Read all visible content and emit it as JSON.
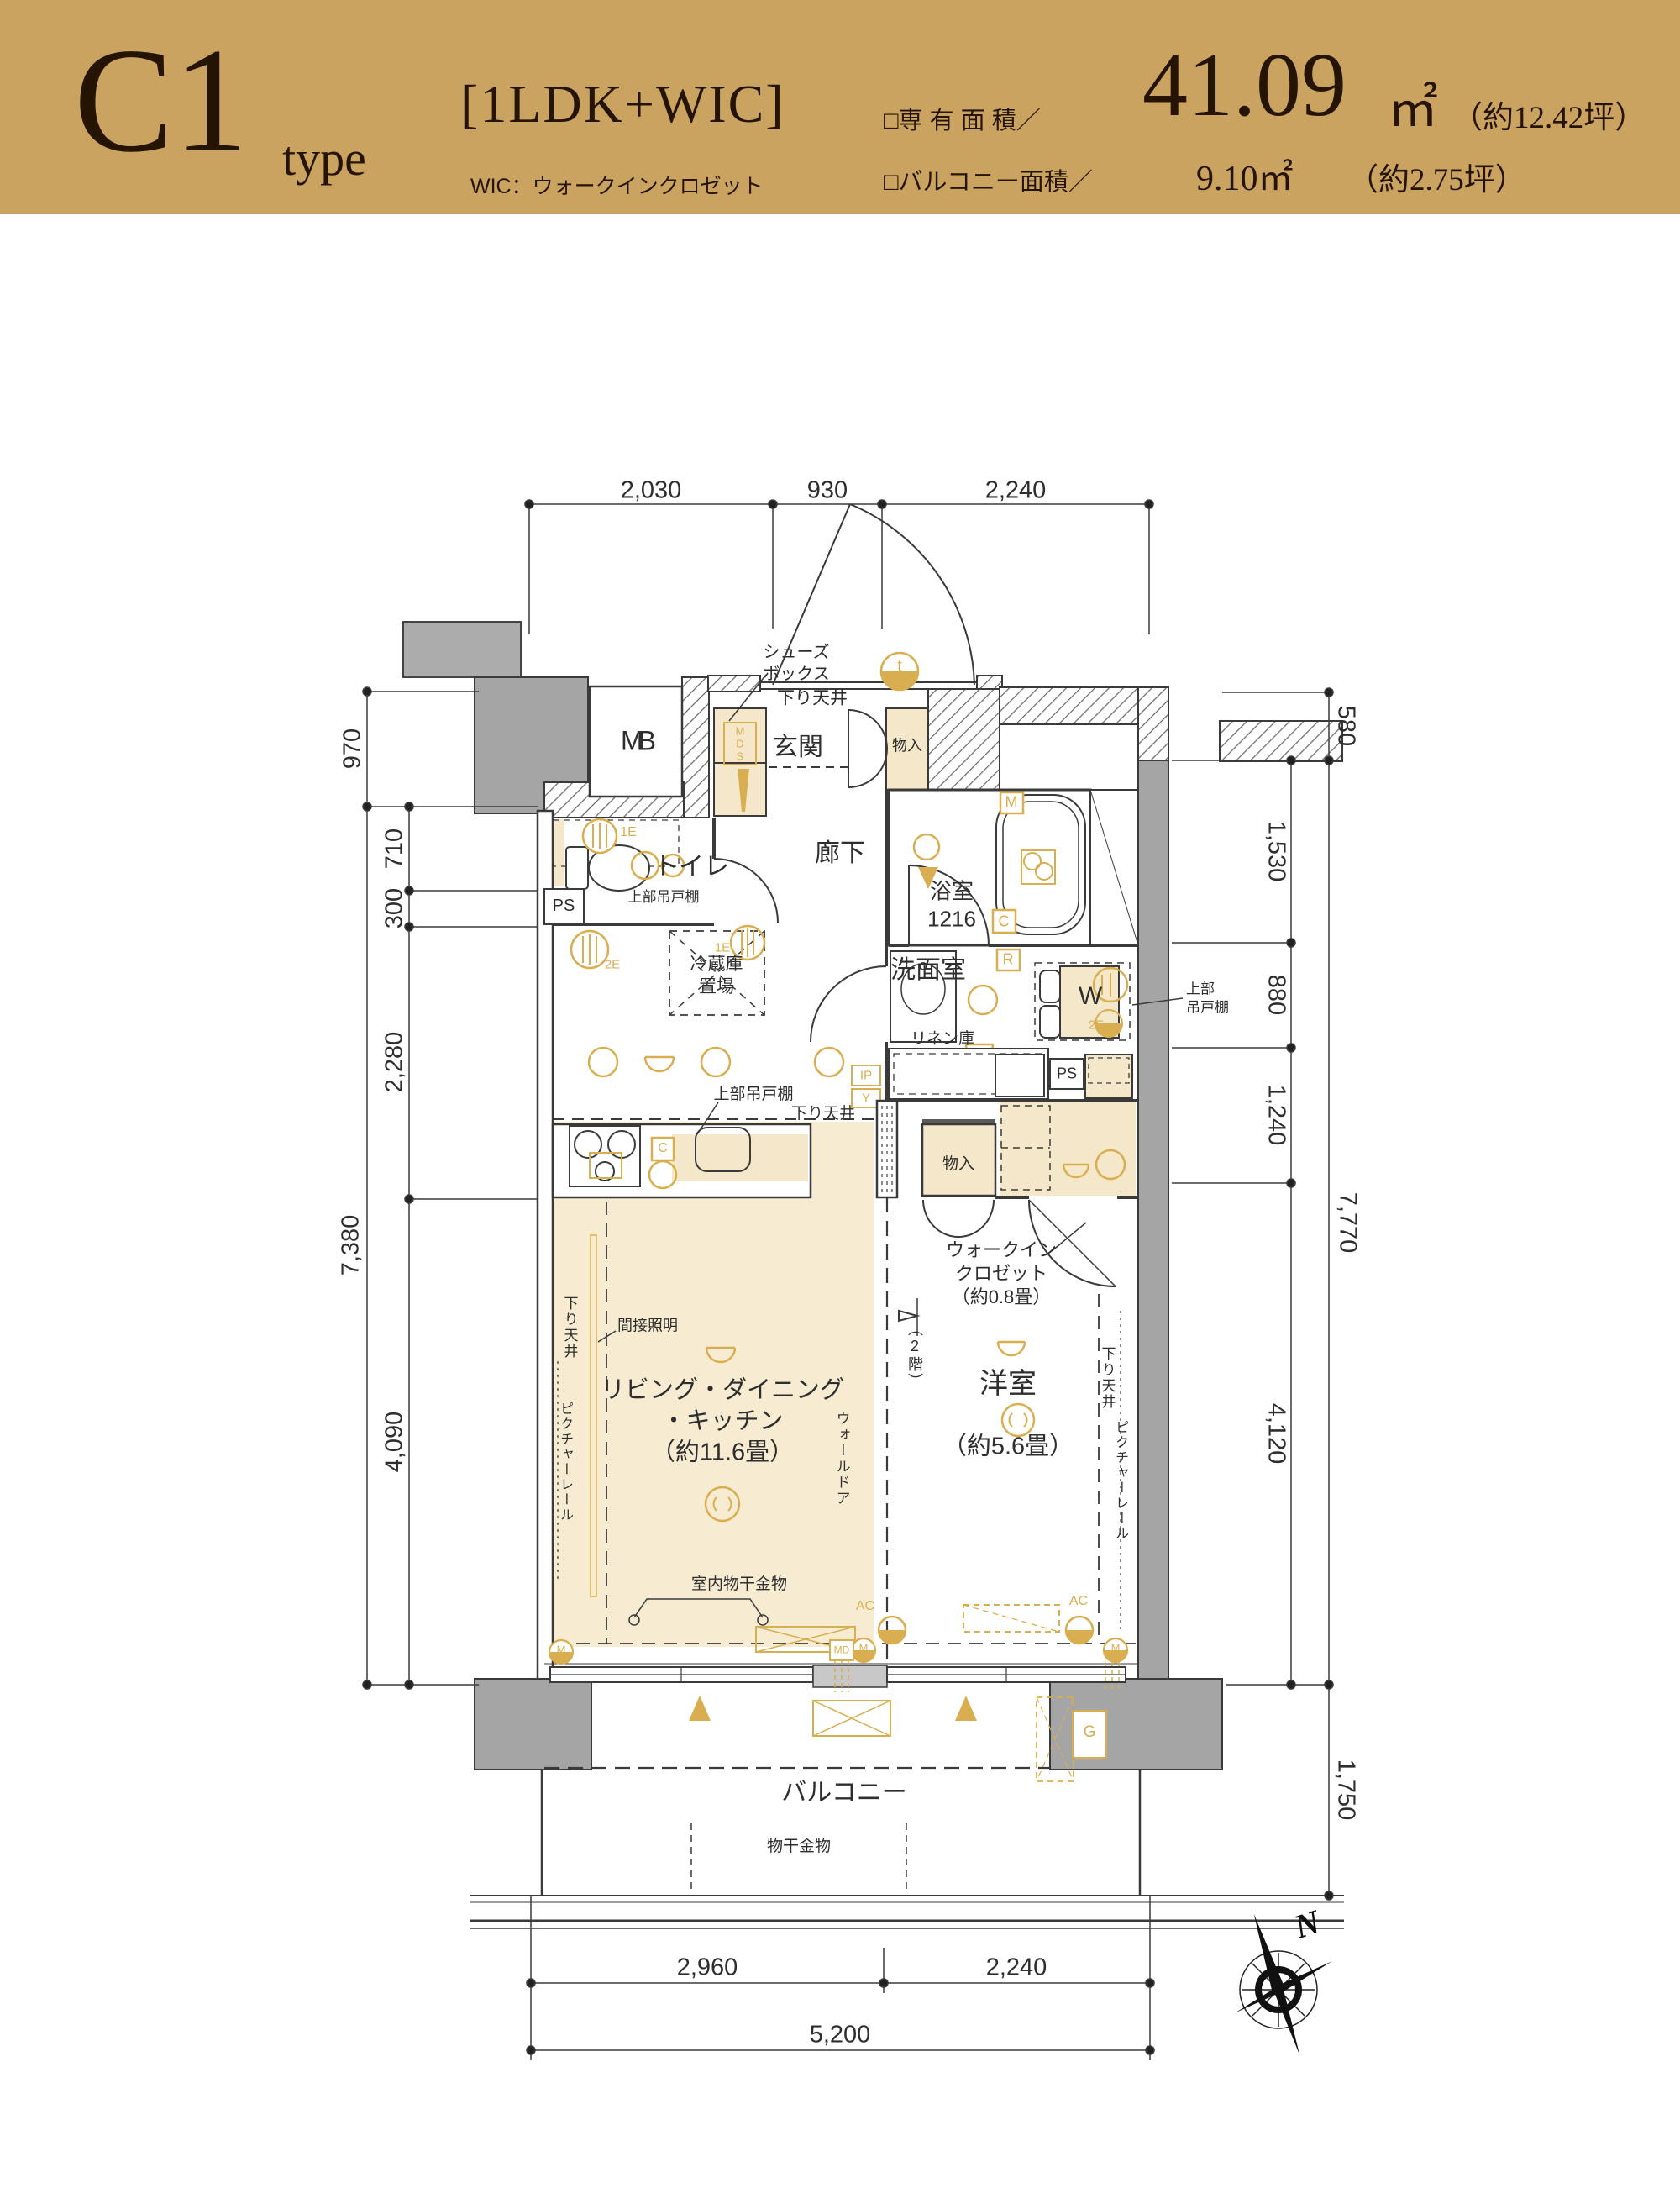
{
  "header": {
    "unit": "C1",
    "unit_suffix": "type",
    "layout": "[1LDK+WIC]",
    "wic_note": "WIC：ウォークインクロゼット",
    "senyu_label": "□専 有 面 積／",
    "senyu_value": "41.09",
    "senyu_unit": "㎡",
    "senyu_tsubo": "（約12.42坪）",
    "balcony_label": "□バルコニー面積／",
    "balcony_value": "9.10㎡",
    "balcony_tsubo": "（約2.75坪）"
  },
  "dimensions": {
    "top": [
      "2,030",
      "930",
      "2,240"
    ],
    "left_outer": [
      "970",
      "7,380"
    ],
    "left_inner": [
      "710",
      "300",
      "2,280",
      "4,090"
    ],
    "right_outer": [
      "580",
      "7,770",
      "1,750"
    ],
    "right_inner": [
      "1,530",
      "880",
      "1,240",
      "4,120"
    ],
    "bottom": [
      "2,960",
      "2,240"
    ],
    "bottom_total": "5,200"
  },
  "rooms": {
    "genkan": "玄関",
    "rouka": "廊下",
    "toilet": "トイレ",
    "bath": "浴室\n1216",
    "senmenshitsu": "洗面室",
    "ldk": "リビング・ダイニング\n・キッチン\n（約11.6畳）",
    "youshitsu": "洋室",
    "youshitsu_size": "（約5.6畳）",
    "wic": "ウォークイン\nクロゼット\n（約0.8畳）",
    "balcony": "バルコニー"
  },
  "features": {
    "mb": "MB",
    "shoes_box": "シューズ\nボックス",
    "sagari_tenjo": "下り天井",
    "mono_ire": "物入",
    "upper_cabinet": "上部吊戸棚",
    "upper_cabinet_2line": "上部\n吊戸棚",
    "reizouko": "冷蔵庫\n置場",
    "ps": "PS",
    "linen": "リネン庫",
    "washer": "W",
    "kansetsu_shomei": "間接照明",
    "picture_rail": "ピクチャーレール",
    "wall_door": "ウォールドア",
    "nikai": "（2階）",
    "muroboshi": "室内物干金物",
    "monohoshi": "物干金物",
    "north": "N"
  },
  "badges": {
    "t": "t",
    "m": "M",
    "c": "C",
    "r": "R",
    "ip": "IP",
    "y": "Y",
    "e1": "1E",
    "e2": "2E",
    "mds": "MDS",
    "ac": "AC",
    "md": "MD",
    "g": "G"
  },
  "colors": {
    "band": "#C9A35F",
    "accent": "#D9AE50",
    "tan": "#F5E8CA",
    "wall_gray": "#A5A5A5",
    "ink": "#261403",
    "line": "#3A3A3A"
  }
}
